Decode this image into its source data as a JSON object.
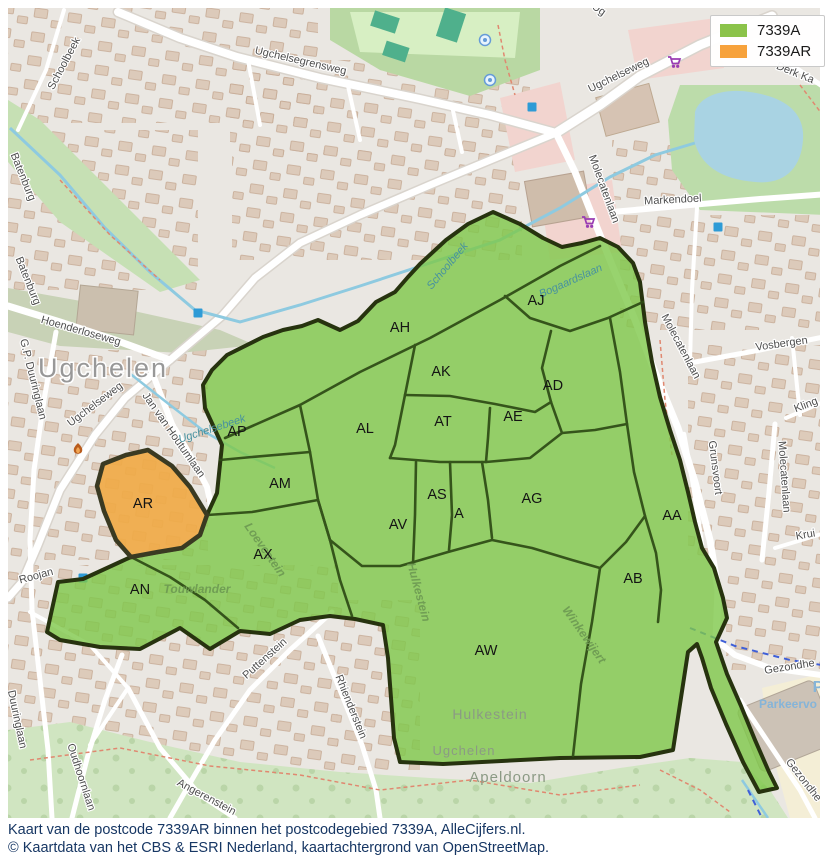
{
  "legend": {
    "items": [
      {
        "label": "7339A",
        "color": "#8bc34a"
      },
      {
        "label": "7339AR",
        "color": "#f7a23c"
      }
    ]
  },
  "caption": {
    "line1": "Kaart van de postcode 7339AR binnen het postcodegebied 7339A, AlleCijfers.nl.",
    "line2": "© Kaartdata van het CBS & ESRI Nederland, kaartachtergrond van OpenStreetMap."
  },
  "postcode_regions": {
    "area_code": "7339A",
    "highlight_code": "7339AR",
    "labels": [
      {
        "t": "AH",
        "x": 400,
        "y": 332
      },
      {
        "t": "AJ",
        "x": 536,
        "y": 305
      },
      {
        "t": "AK",
        "x": 441,
        "y": 376
      },
      {
        "t": "AD",
        "x": 553,
        "y": 390
      },
      {
        "t": "AL",
        "x": 365,
        "y": 433
      },
      {
        "t": "AT",
        "x": 443,
        "y": 426
      },
      {
        "t": "AE",
        "x": 513,
        "y": 421
      },
      {
        "t": "AP",
        "x": 237,
        "y": 436
      },
      {
        "t": "AM",
        "x": 280,
        "y": 488
      },
      {
        "t": "AS",
        "x": 437,
        "y": 499
      },
      {
        "t": "A",
        "x": 459,
        "y": 518
      },
      {
        "t": "AV",
        "x": 398,
        "y": 529
      },
      {
        "t": "AG",
        "x": 532,
        "y": 503
      },
      {
        "t": "AR",
        "x": 143,
        "y": 508
      },
      {
        "t": "AX",
        "x": 263,
        "y": 559
      },
      {
        "t": "AN",
        "x": 140,
        "y": 594
      },
      {
        "t": "AA",
        "x": 672,
        "y": 520
      },
      {
        "t": "AB",
        "x": 633,
        "y": 583
      },
      {
        "t": "AW",
        "x": 486,
        "y": 655
      }
    ]
  },
  "basemap": {
    "town_label": {
      "t": "Ugchelen",
      "x": 103,
      "y": 377
    },
    "street_labels": [
      {
        "t": "Schoolbeek",
        "x": 67,
        "y": 65,
        "r": -62
      },
      {
        "t": "Batenburg",
        "x": 20,
        "y": 178,
        "r": 68
      },
      {
        "t": "Batenburg",
        "x": 25,
        "y": 282,
        "r": 68
      },
      {
        "t": "Ugchelsegrensweg",
        "x": 300,
        "y": 64,
        "r": 13
      },
      {
        "t": "Ugchelseweg",
        "x": 620,
        "y": 78,
        "r": -26
      },
      {
        "t": "Derk Ka",
        "x": 794,
        "y": 76,
        "r": 22
      },
      {
        "t": "Ug",
        "x": 597,
        "y": 12,
        "r": 35,
        "s": 10
      },
      {
        "t": "Markendoel",
        "x": 673,
        "y": 203,
        "r": -3
      },
      {
        "t": "Molecatenlaan",
        "x": 601,
        "y": 190,
        "r": 70
      },
      {
        "t": "Molecatenlaan",
        "x": 678,
        "y": 348,
        "r": 62
      },
      {
        "t": "Molecatenlaan",
        "x": 781,
        "y": 477,
        "r": 86
      },
      {
        "t": "Vosbergen",
        "x": 782,
        "y": 347,
        "r": -8
      },
      {
        "t": "Kling",
        "x": 807,
        "y": 408,
        "r": -21
      },
      {
        "t": "Grunsvoort",
        "x": 712,
        "y": 468,
        "r": 83
      },
      {
        "t": "Krui",
        "x": 806,
        "y": 538,
        "r": -10
      },
      {
        "t": "Hoenderloseweg",
        "x": 80,
        "y": 334,
        "r": 16
      },
      {
        "t": "G.P. Duuringlaan",
        "x": 30,
        "y": 380,
        "r": 76
      },
      {
        "t": "Ugchelseweg",
        "x": 97,
        "y": 407,
        "r": -37
      },
      {
        "t": "Jan van Houtumlaan",
        "x": 171,
        "y": 437,
        "r": 55
      },
      {
        "t": "Roojan",
        "x": 37,
        "y": 579,
        "r": -15
      },
      {
        "t": "Duuringlaan",
        "x": 14,
        "y": 720,
        "r": 78
      },
      {
        "t": "Oudhoornlaan",
        "x": 78,
        "y": 778,
        "r": 72
      },
      {
        "t": "Puttenstein",
        "x": 267,
        "y": 661,
        "r": -42
      },
      {
        "t": "Angerenstein",
        "x": 205,
        "y": 800,
        "r": 28
      },
      {
        "t": "Rhienderstein",
        "x": 348,
        "y": 708,
        "r": 68
      },
      {
        "t": "Gezondhe",
        "x": 790,
        "y": 670,
        "r": -9
      },
      {
        "t": "Gezondhe",
        "x": 801,
        "y": 782,
        "r": 52
      }
    ],
    "water_labels": [
      {
        "t": "Schoolbeek",
        "x": 450,
        "y": 268,
        "r": -50
      },
      {
        "t": "Ugchelsebeek",
        "x": 213,
        "y": 432,
        "r": -18
      },
      {
        "t": "Bogaardslaan",
        "x": 572,
        "y": 284,
        "r": -24
      }
    ],
    "park_labels": [
      {
        "t": "Touwlander",
        "x": 197,
        "y": 593,
        "r": 0,
        "s": 13
      },
      {
        "t": "Loevestein",
        "x": 262,
        "y": 552,
        "r": 55
      },
      {
        "t": "Winkewijert",
        "x": 581,
        "y": 637,
        "r": 55,
        "s": 11
      },
      {
        "t": "Hulkestein",
        "x": 415,
        "y": 593,
        "r": 75
      }
    ],
    "area_labels": [
      {
        "t": "Hulkestein",
        "x": 490,
        "y": 719,
        "s": 14
      },
      {
        "t": "Ugchelen",
        "x": 464,
        "y": 755,
        "s": 13
      },
      {
        "t": "Apeldoorn",
        "x": 508,
        "y": 782,
        "s": 15
      }
    ],
    "poi_labels": [
      {
        "t": "Parkeervo",
        "x": 788,
        "y": 708,
        "s": 12
      },
      {
        "t": "P",
        "x": 818,
        "y": 692,
        "s": 16
      }
    ],
    "icons": [
      {
        "n": "supermarket-icon",
        "x": 674,
        "y": 62
      },
      {
        "n": "supermarket-icon",
        "x": 588,
        "y": 222
      },
      {
        "n": "fire-icon",
        "x": 78,
        "y": 450
      },
      {
        "n": "parking-square-icon",
        "x": 532,
        "y": 107
      },
      {
        "n": "parking-square-icon",
        "x": 198,
        "y": 313
      },
      {
        "n": "parking-square-icon",
        "x": 83,
        "y": 578
      },
      {
        "n": "parking-square-icon",
        "x": 718,
        "y": 227
      },
      {
        "n": "playground-icon",
        "x": 485,
        "y": 40
      },
      {
        "n": "playground-icon",
        "x": 490,
        "y": 80
      }
    ]
  },
  "colors": {
    "overlay_green": "#7ec84a",
    "overlay_orange": "#f0aa47",
    "outer_boundary": "#27330f",
    "inner_boundary": "#2d4a15",
    "caption_text": "#173764"
  }
}
